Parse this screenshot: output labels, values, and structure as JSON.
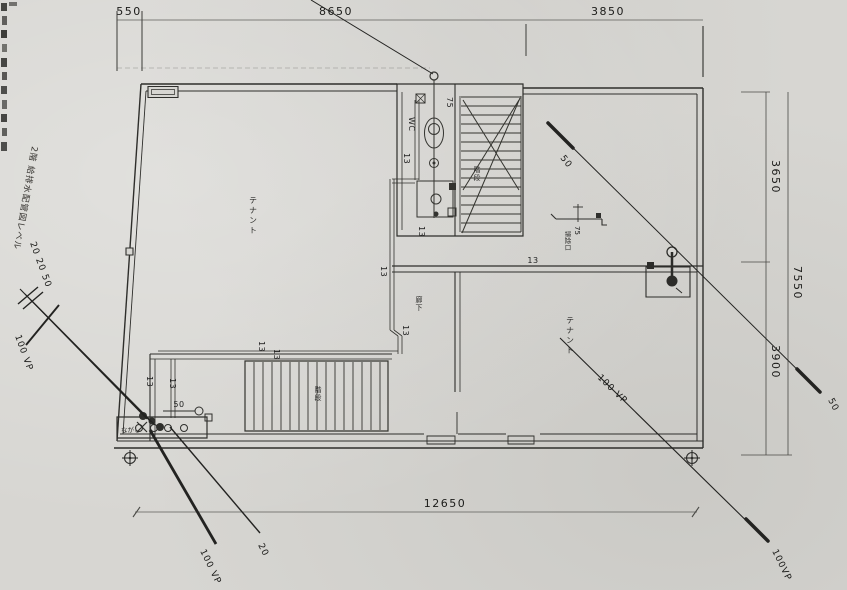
{
  "title": {
    "margin_note": "2階 給排水配管図レベル"
  },
  "dimensions": {
    "top": {
      "d550": "550",
      "d8650": "8650",
      "d3850": "3850"
    },
    "right": {
      "d3650": "3650",
      "d7550": "7550",
      "d3900": "3900"
    },
    "bottom": {
      "d12650": "12650"
    }
  },
  "rooms": {
    "tenant_left": "テナント",
    "tenant_right": "テナント",
    "wc": "WC",
    "corridor": "廊下",
    "stair_upper": "階段",
    "stair_lower": "階段",
    "sink": "ながし"
  },
  "pipes": {
    "wc_vent_75": "75",
    "wc_13_upper": "13",
    "wc_13_lower": "13",
    "main_13_upper": "13",
    "main_13_lower": "13",
    "corridor_13": "13",
    "branch_13_left": "13",
    "branch_13_right": "13",
    "west_13_left": "13",
    "west_13_right": "13",
    "sink_50": "50",
    "cleanout_75": "75",
    "cleanout_name": "掃除口"
  },
  "leaders": {
    "vent_50_start": "50",
    "vent_50_end": "50",
    "drain_100vp": "100 VP",
    "drain_100vp_end": "100VP",
    "supply_sizes": "20 20 50",
    "supply_100vp_west": "100 VP",
    "waste_100vp_sw": "100 VP",
    "waste_20_sw": "20"
  }
}
